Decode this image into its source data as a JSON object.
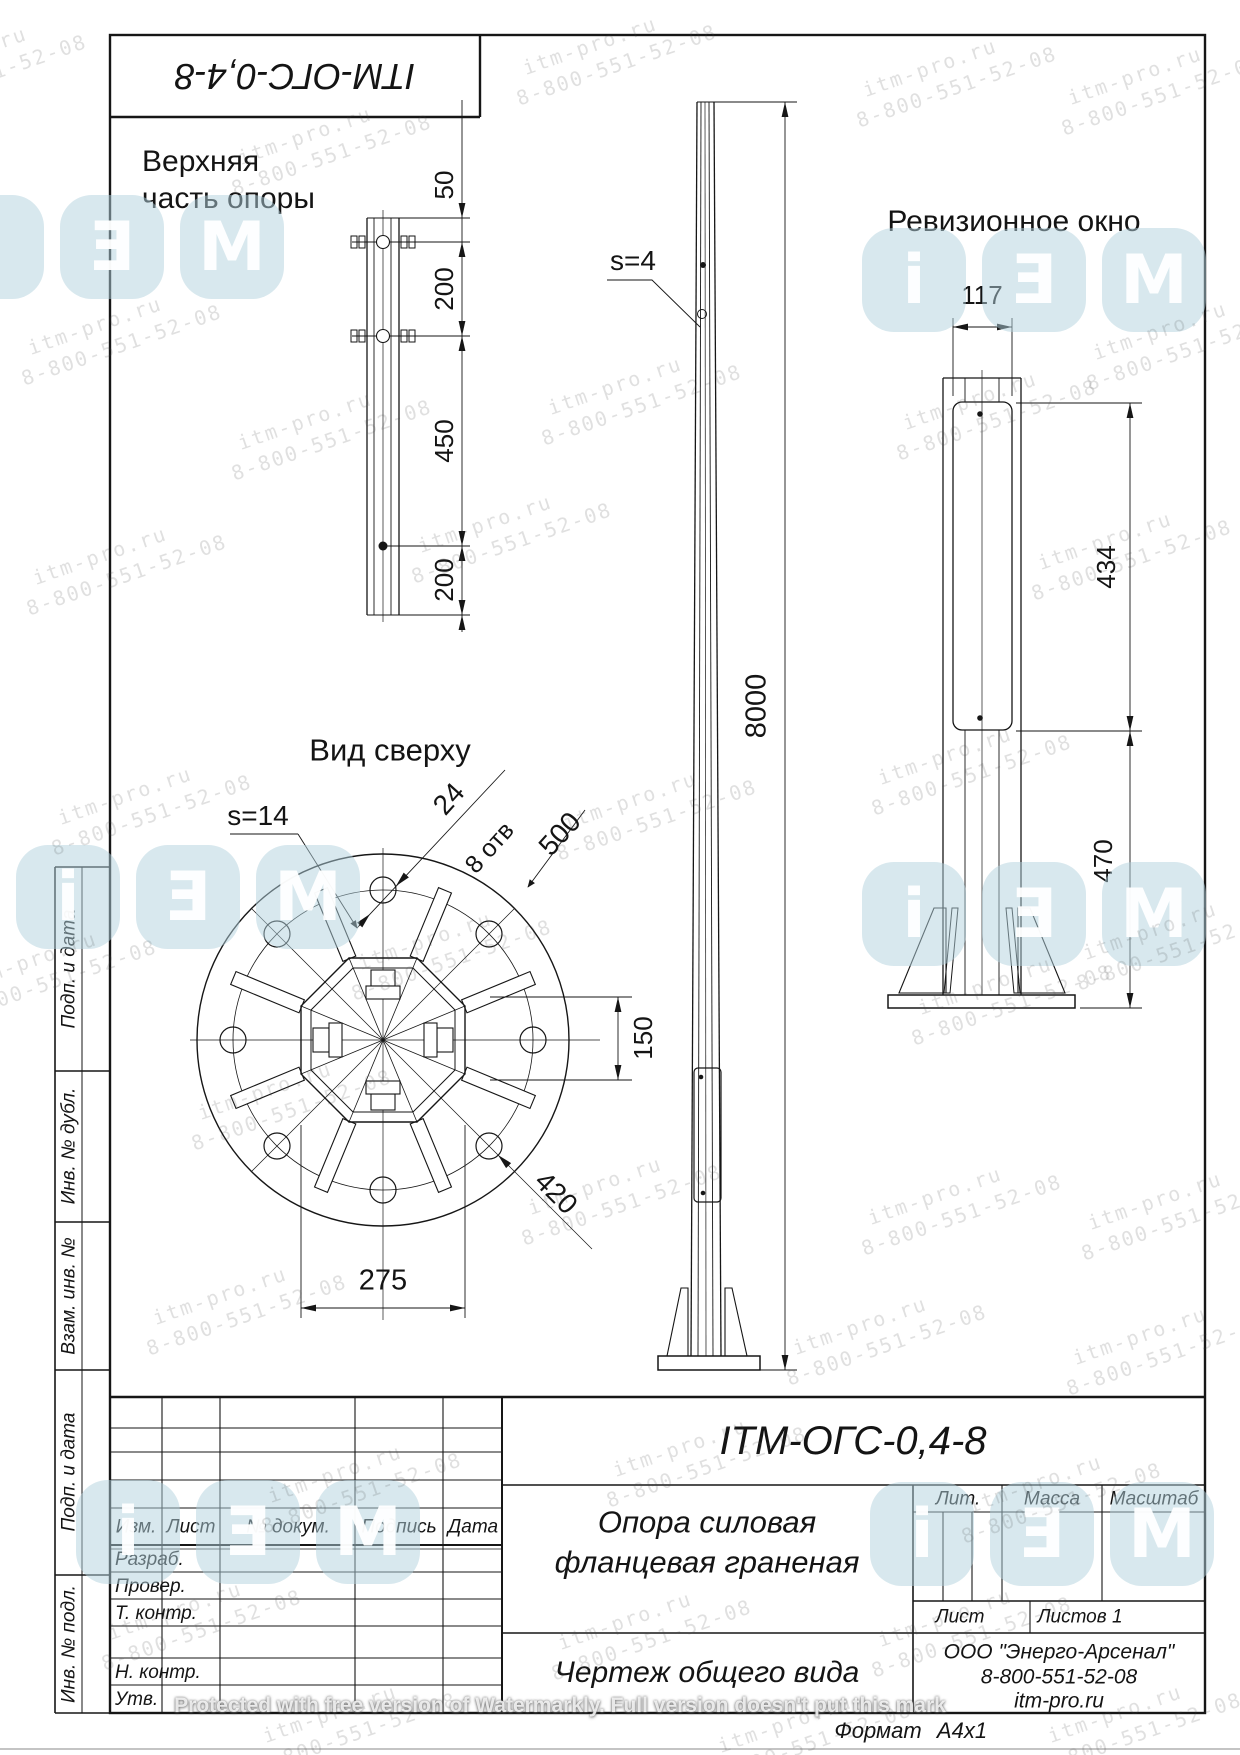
{
  "stamp": {
    "code": "ITM-ОГС-0,4-8"
  },
  "views": {
    "upper": {
      "title1": "Верхняя",
      "title2": "часть опоры",
      "d1": "50",
      "d2": "200",
      "d3": "450",
      "d4": "200"
    },
    "front": {
      "thickness": "s=4",
      "height": "8000"
    },
    "side": {
      "title": "Ревизионное окно",
      "width": "117",
      "h_window": "434",
      "h_base": "470"
    },
    "plan": {
      "title": "Вид сверху",
      "thickness": "s=14",
      "hole_d": "24",
      "hole_count": "8 отв",
      "flange_d": "500",
      "offset": "150",
      "bolt_circle": "420",
      "across_flats": "275"
    }
  },
  "sidebar": {
    "labels": [
      "Подп. и дата",
      "Инв. № дубл.",
      "Взам. инв. №",
      "Подп. и дата",
      "Инв. № подл."
    ]
  },
  "title_block": {
    "designation": "ITM-ОГС-0,4-8",
    "name1": "Опора силовая",
    "name2": "фланцевая граненая",
    "doc_type": "Чертеж общего вида",
    "cols": [
      "Изм.",
      "Лист",
      "№ докум.",
      "Подпись",
      "Дата"
    ],
    "rows": [
      "Разраб.",
      "Провер.",
      "Т. контр.",
      "Н. контр.",
      "Утв."
    ],
    "lit": "Лит.",
    "mass": "Масса",
    "scale": "Масштаб",
    "sheet": "Лист",
    "sheets": "Листов 1",
    "company": "ООО \"Энерго-Арсенал\"",
    "phone": "8-800-551-52-08",
    "site": "itm-pro.ru",
    "format_label": "Формат",
    "format_value": "А4х1"
  },
  "watermarks": {
    "line1": "itm-pro.ru",
    "line2": "8-800-551-52-08",
    "protected": "Protected with free version of Watermarkly. Full version doesn't put this mark",
    "logo_letters": [
      "i",
      "E",
      "M"
    ]
  }
}
